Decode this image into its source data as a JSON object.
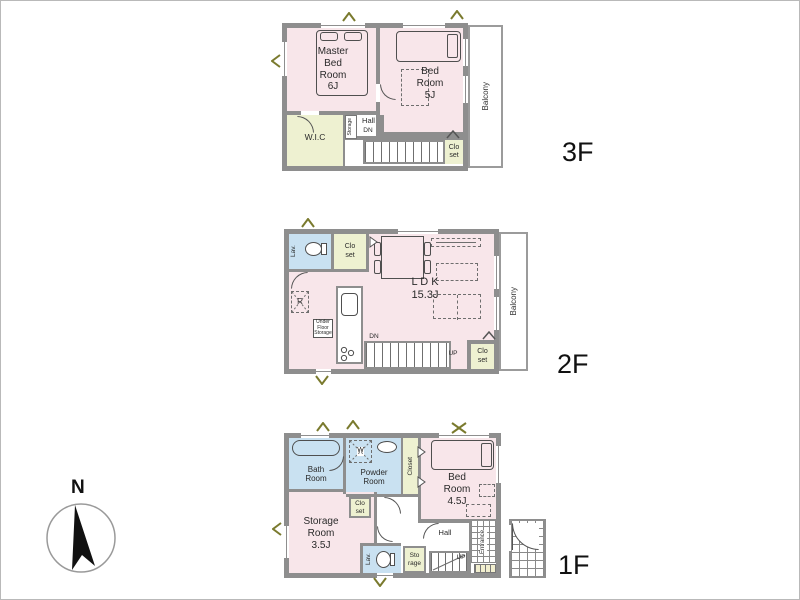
{
  "colors": {
    "room_pink": "#f8e6ea",
    "room_green": "#eef1d1",
    "room_blue": "#c9e1f1",
    "wall_gray": "#8e8e8e",
    "mark_olive": "#7a7a2e"
  },
  "compass": {
    "north_label": "N"
  },
  "floor3": {
    "label": "3F",
    "master_bedroom": "Master\nBed\nRoom\n6J",
    "bedroom": "Bed\nRoom\n5J",
    "wic": "W.I.C",
    "storage_strip": "Storage",
    "hall": "Hall",
    "stairs_down": "DN",
    "closet": "Clo\nset",
    "balcony": "Balcony"
  },
  "floor2": {
    "label": "2F",
    "lavatory": "Lav.",
    "closet_top": "Clo\nset",
    "ldk": "L D K\n15.3J",
    "refrigerator": "R",
    "under_floor_storage": "Under\nFloor\nStorage",
    "stairs_down": "DN",
    "stairs_up": "UP",
    "closet_bottom": "Clo\nset",
    "balcony": "Balcony"
  },
  "floor1": {
    "label": "1F",
    "bathroom": "Bath\nRoom",
    "powder_room": "Powder\nRoom",
    "washer": "W",
    "closet_tall": "Closet",
    "bedroom": "Bed\nRoom\n4.5J",
    "closet_small": "Clo\nset",
    "storage_room": "Storage\nRoom\n3.5J",
    "hall": "Hall",
    "lavatory": "Lav.",
    "storage_small": "Sto\nrage",
    "stairs_up": "UP",
    "entrance": "Entrance"
  }
}
